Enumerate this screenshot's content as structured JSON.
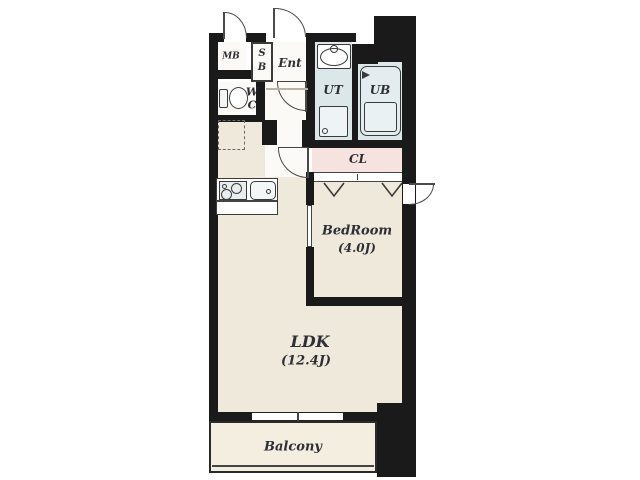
{
  "title": "1LDK apartment floor plan",
  "rooms": {
    "mb": {
      "label": "MB"
    },
    "sb": {
      "line1": "S",
      "line2": "B"
    },
    "ent": {
      "label": "Ent"
    },
    "wc": {
      "line1": "W",
      "line2": "C"
    },
    "ut": {
      "label": "UT"
    },
    "ub": {
      "label": "UB"
    },
    "cl": {
      "label": "CL"
    },
    "bedroom": {
      "label": "BedRoom",
      "size": "(4.0J)"
    },
    "ldk": {
      "label": "LDK",
      "size": "(12.4J)"
    },
    "balcony": {
      "label": "Balcony"
    }
  },
  "colors": {
    "wall": "#1a1a1a",
    "floor_main": "#efe9db",
    "floor_wet": "#dce7ea",
    "floor_closet": "#f6e3df",
    "floor_entry": "#fbfaf6",
    "floor_balcony": "#f3eee0"
  },
  "icons": [
    "toilet-icon",
    "washbasin-icon",
    "washing-machine-icon",
    "bathtub-icon",
    "stove-icon",
    "kitchen-sink-icon",
    "refrigerator-space-icon",
    "door-swing-arc-icon",
    "sliding-closet-mark-icon",
    "sliding-window-icon"
  ]
}
